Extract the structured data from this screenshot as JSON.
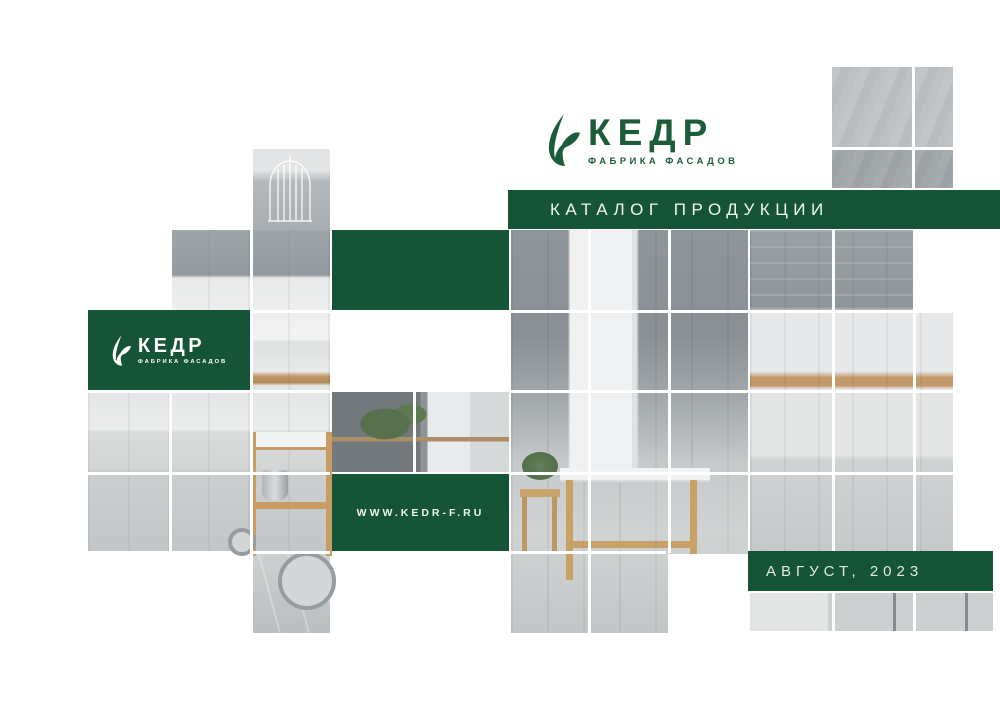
{
  "brand": {
    "title": "КЕДР",
    "subtitle": "ФАБРИКА ФАСАДОВ",
    "icon": "cedar-leaf-icon"
  },
  "banner": {
    "label": "КАТАЛОГ ПРОДУКЦИИ"
  },
  "side_badge": {
    "title": "КЕДР",
    "subtitle": "ФАБРИКА ФАСАДОВ",
    "icon": "cedar-leaf-icon"
  },
  "website": {
    "label": "WWW.KEDR-F.RU"
  },
  "issue": {
    "label": "АВГУСТ, 2023"
  },
  "colors": {
    "brand_green": "#165437",
    "logo_green": "#1c5c39"
  }
}
